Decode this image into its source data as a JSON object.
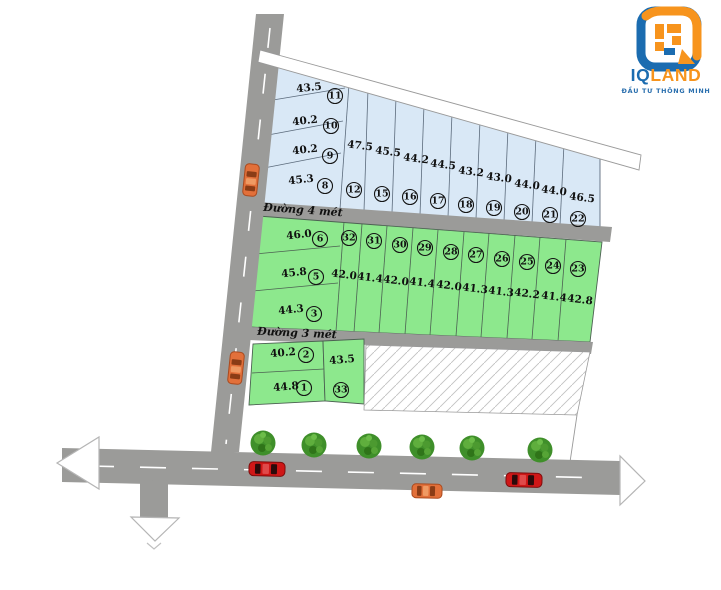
{
  "logo": {
    "brand_iq": "IQ",
    "brand_land": "LAND",
    "tagline": "ĐẦU TƯ THÔNG MINH"
  },
  "road_labels": {
    "road_4m": "Đường 4 mét",
    "road_3m": "Đường 3 mét"
  },
  "colors": {
    "plot_blue": "#d9e8f6",
    "plot_green": "#8de88d",
    "road_gray": "#9b9b99",
    "logo_blue": "#1b6cb0",
    "logo_orange": "#f7941d",
    "car_red": "#cf1717",
    "car_orange": "#e2703a",
    "tree_green": "#3f8f2a"
  },
  "plots": {
    "p1": {
      "num": "1",
      "area": "44.8"
    },
    "p2": {
      "num": "2",
      "area": "40.2"
    },
    "p3": {
      "num": "3",
      "area": "44.3"
    },
    "p5": {
      "num": "5",
      "area": "45.8"
    },
    "p6": {
      "num": "6",
      "area": "46.0"
    },
    "p8": {
      "num": "8",
      "area": "45.3"
    },
    "p9": {
      "num": "9",
      "area": "40.2"
    },
    "p10": {
      "num": "10",
      "area": "40.2"
    },
    "p11": {
      "num": "11",
      "area": "43.5"
    },
    "p12": {
      "num": "12",
      "area": "47.5"
    },
    "p15": {
      "num": "15",
      "area": "45.5"
    },
    "p16": {
      "num": "16",
      "area": "44.2"
    },
    "p17": {
      "num": "17",
      "area": "44.5"
    },
    "p18": {
      "num": "18",
      "area": "43.2"
    },
    "p19": {
      "num": "19",
      "area": "43.0"
    },
    "p20": {
      "num": "20",
      "area": "44.0"
    },
    "p21": {
      "num": "21",
      "area": "44.0"
    },
    "p22": {
      "num": "22",
      "area": "46.5"
    },
    "p23": {
      "num": "23",
      "area": "42.8"
    },
    "p24": {
      "num": "24",
      "area": "41.4"
    },
    "p25": {
      "num": "25",
      "area": "42.2"
    },
    "p26": {
      "num": "26",
      "area": "41.3"
    },
    "p27": {
      "num": "27",
      "area": "41.3"
    },
    "p28": {
      "num": "28",
      "area": "42.0"
    },
    "p29": {
      "num": "29",
      "area": "41.4"
    },
    "p30": {
      "num": "30",
      "area": "42.0"
    },
    "p31": {
      "num": "31",
      "area": "41.4"
    },
    "p32": {
      "num": "32",
      "area": "42.0"
    },
    "p33": {
      "num": "33",
      "area": "43.5"
    }
  }
}
